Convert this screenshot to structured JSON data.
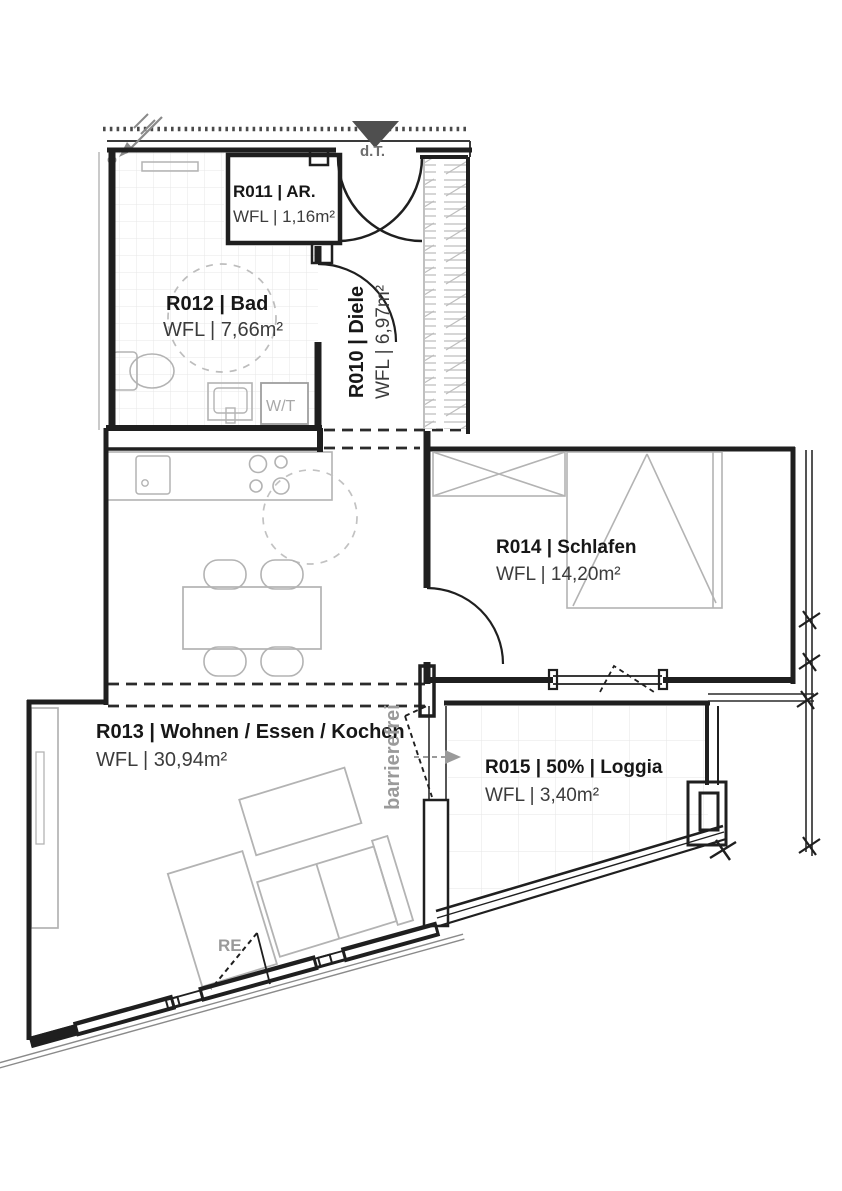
{
  "plan": {
    "rooms": [
      {
        "id": "R010",
        "name": "R010 | Diele",
        "area": "WFL | 6,97m²"
      },
      {
        "id": "R011",
        "name": "R011 | AR.",
        "area": "WFL | 1,16m²"
      },
      {
        "id": "R012",
        "name": "R012 | Bad",
        "area": "WFL | 7,66m²"
      },
      {
        "id": "R013",
        "name": "R013 | Wohnen / Essen / Kochen",
        "area": "WFL | 30,94m²"
      },
      {
        "id": "R014",
        "name": "R014 | Schlafen",
        "area": "WFL | 14,20m²"
      },
      {
        "id": "R015",
        "name": "R015 | 50% | Loggia",
        "area": "WFL | 3,40m²"
      }
    ],
    "annotations": {
      "entrance_door": "d.T.",
      "washer_dryer": "W/T",
      "barrier_free": "barrierefrei",
      "window_vent": "RE"
    },
    "colors": {
      "wall": "#1f1f1f",
      "furniture": "#b3b3b3",
      "tile_line": "#e7e7e7",
      "gray_label": "#9a9a9a",
      "entrance_marker": "#4f4f4f"
    }
  }
}
